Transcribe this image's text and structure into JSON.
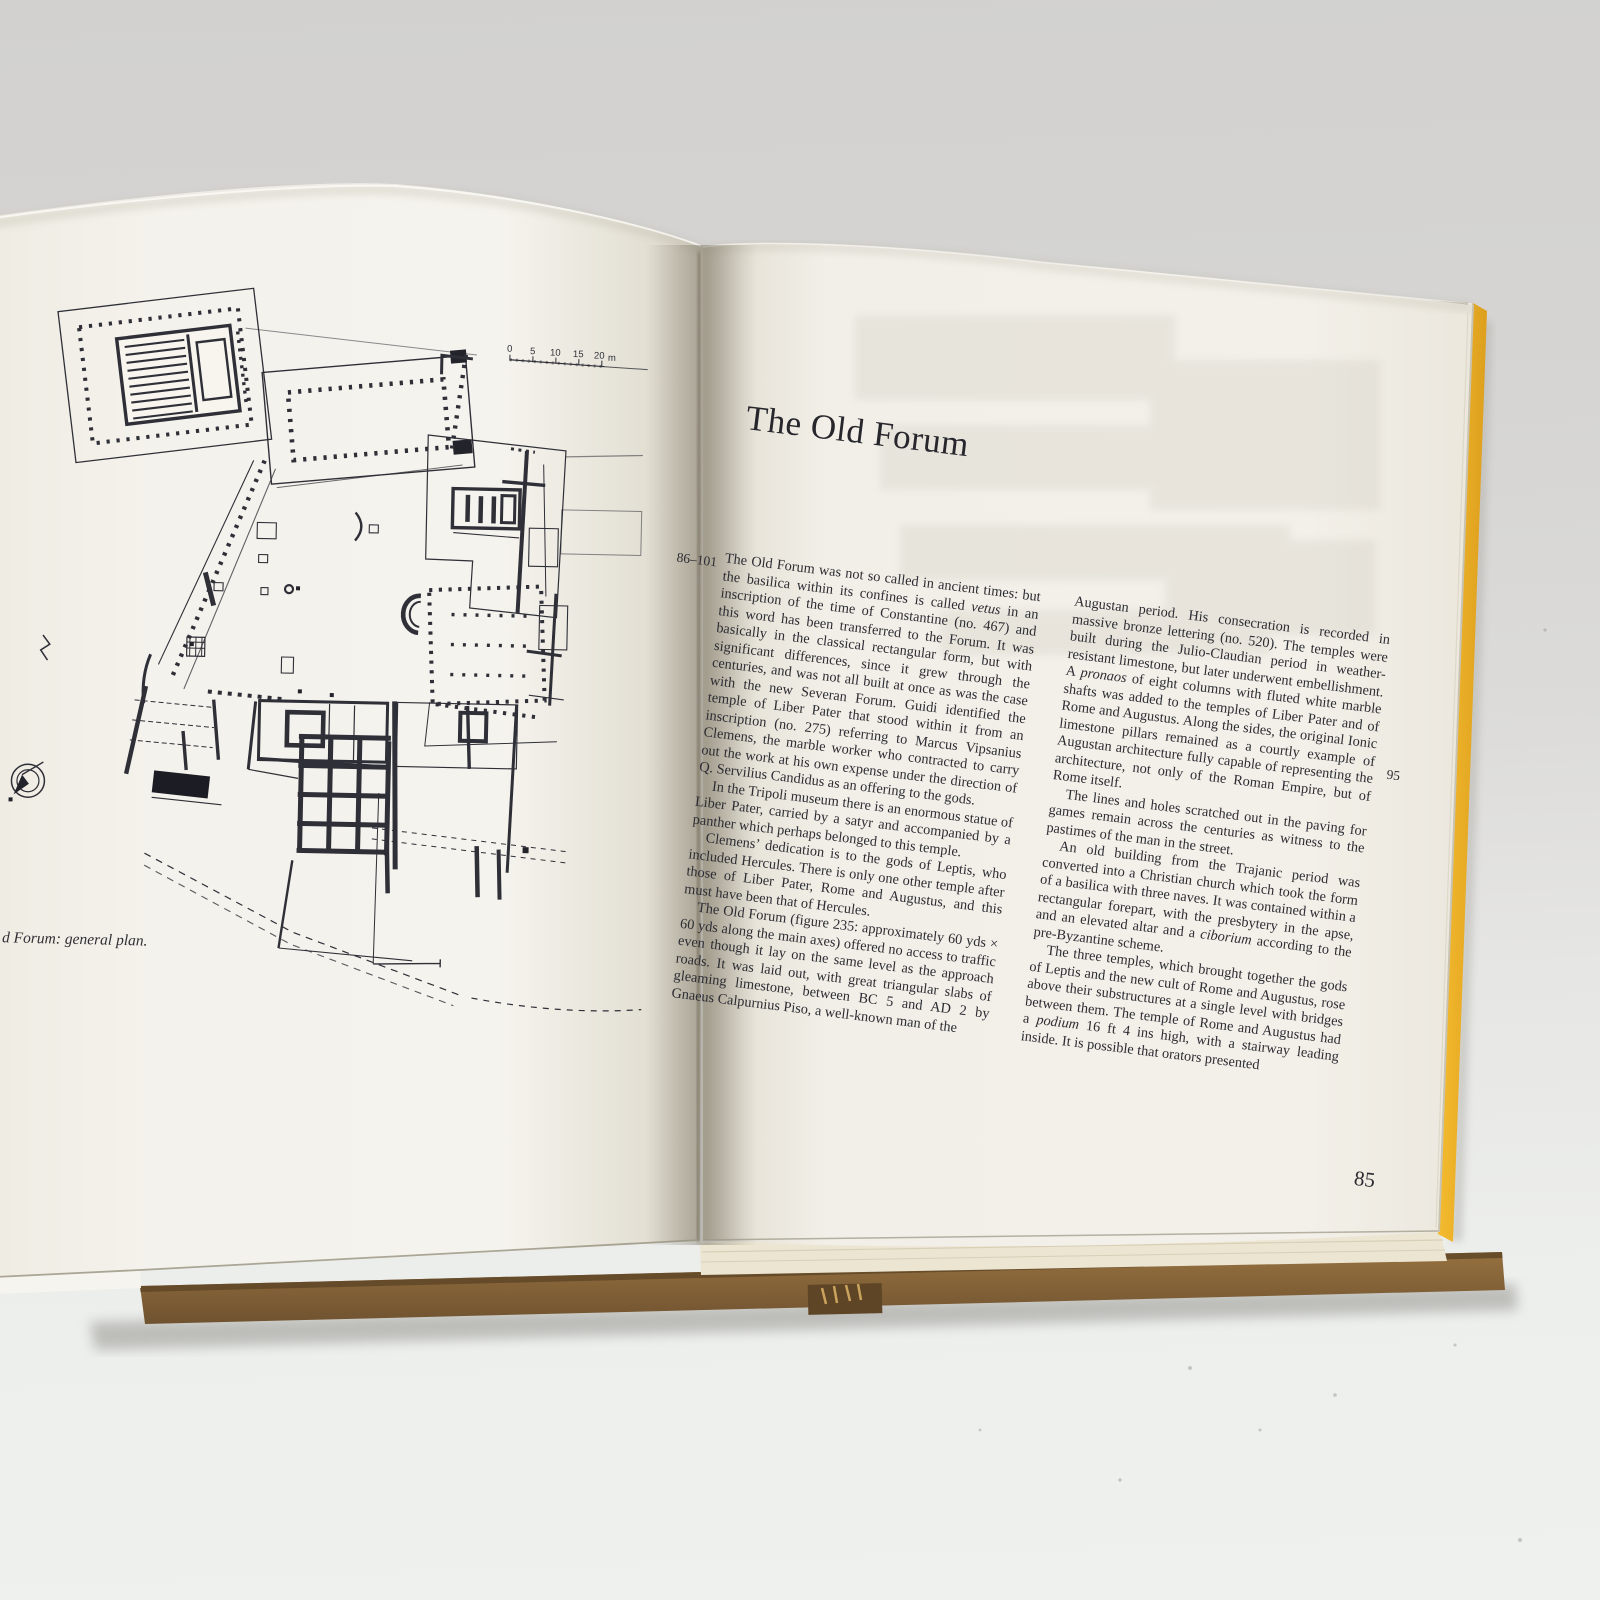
{
  "book": {
    "left_page": {
      "figure": {
        "caption": "d Forum: general plan.",
        "scale_bar": {
          "tick_0": "0",
          "tick_5": "5",
          "tick_10": "10",
          "tick_15": "15",
          "tick_20": "20",
          "unit": "m"
        }
      }
    },
    "right_page": {
      "heading": "The Old Forum",
      "margin_reference": "86–101",
      "margin_reference_2": "95",
      "page_number": "85",
      "column_1": [
        {
          "text": "The Old Forum was not so called in ancient times: but the basilica within its confines is called *vetus* in an inscription of the time of Constantine (no. 467) and this word has been transferred to the Forum. It was basically in the classical rectangular form, but with significant differences, since it grew through the centuries, and was not all built at once as was the case with the new Severan Forum. Guidi identified the temple of Liber Pater that stood within it from an inscription (no. 275) referring to Marcus Vipsanius Clemens, the marble worker who contracted to carry out the work at his own expense under the direction of Q. Servilius Candidus as an offering to the gods."
        },
        {
          "text": "In the Tripoli museum there is an enormous statue of Liber Pater, carried by a satyr and accompanied by a panther which perhaps belonged to this temple."
        },
        {
          "text": "Clemens’ dedication is to the gods of Leptis, who included Hercules. There is only one other temple after those of Liber Pater, Rome and Augustus, and this must have been that of Hercules."
        },
        {
          "text": "The Old Forum (figure 235: approximately 60 yds × 60 yds along the main axes) offered no access to traffic even though it lay on the same level as the approach roads. It was laid out, with great triangular slabs of gleaming limestone, between BC 5 and AD 2 by Gnaeus Calpurnius Piso, a well-known man of the"
        }
      ],
      "column_2": [
        {
          "text": "Augustan period. His consecration is recorded in massive bronze lettering (no. 520). The temples were built during the Julio-Claudian period in weather-resistant limestone, but later underwent embellishment. A *pronaos* of eight columns with fluted white marble shafts was added to the temples of Liber Pater and of Rome and Augustus. Along the sides, the original Ionic limestone pillars remained as a courtly example of Augustan architecture fully capable of representing the architecture, not only of the Roman Empire, but of Rome itself."
        },
        {
          "text": "The lines and holes scratched out in the paving for games remain across the centuries as witness to the pastimes of the man in the street."
        },
        {
          "text": "An old building from the Trajanic period was converted into a Christian church which took the form of a basilica with three naves. It was contained within a rectangular forepart, with the presbytery in the apse, and an elevated altar and a *ciborium* according to the pre-Byzantine scheme."
        },
        {
          "text": "The three temples, which brought together the gods of Leptis and the new cult of Rome and Augustus, rose above their substructures at a single level with bridges between them. The temple of Rome and Augustus had a *podium* 16 ft 4 ins high, with a stairway leading inside. It is possible that orators presented"
        }
      ]
    },
    "colors": {
      "cover_cloth": "#7d5c36",
      "cover_edge_yellow": "#eeb02a",
      "page": "#f2efe8",
      "background": "#d5d4d2",
      "ink": "#2b2b31"
    }
  }
}
